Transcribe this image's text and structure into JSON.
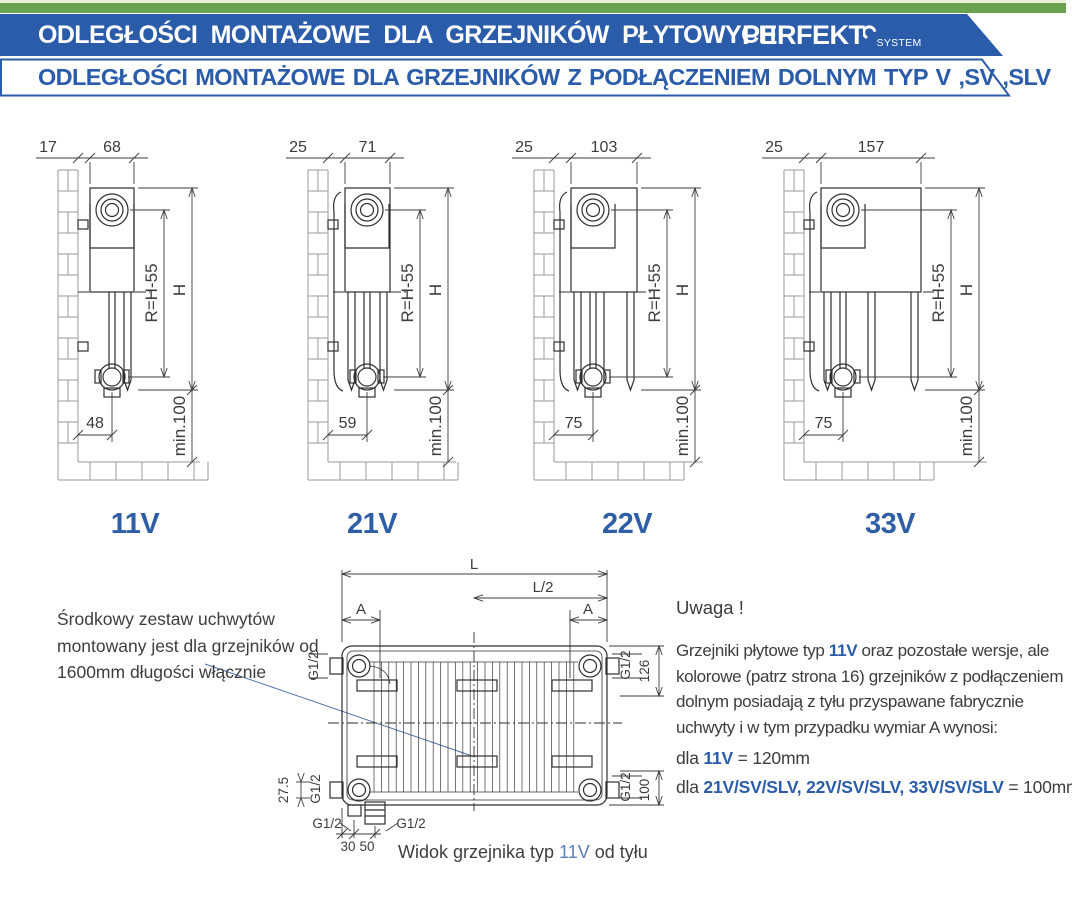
{
  "header": {
    "strip_pale_green": "#e9f3da",
    "strip_green": "#69a350",
    "accent_blue": "#2a5ca9",
    "title": "ODLEGŁOŚCI MONTAŻOWE DLA GRZEJNIKÓW PŁYTOWYCH",
    "logo": {
      "text": "PERFEKT",
      "sub": "SYSTEM"
    },
    "subtitle": "ODLEGŁOŚCI MONTAŻOWE DLA GRZEJNIKÓW Z PODŁĄCZENIEM DOLNYM TYP V ,SV ,SLV"
  },
  "diagrams": [
    {
      "type_label": "11V",
      "wall_gap": "17",
      "depth": "68",
      "r_label": "R=H-55",
      "h_label": "H",
      "bottom_dim": "48",
      "floor_label": "min.100",
      "panels": 1,
      "center_pipe": false
    },
    {
      "type_label": "21V",
      "wall_gap": "25",
      "depth": "71",
      "r_label": "R=H-55",
      "h_label": "H",
      "bottom_dim": "59",
      "floor_label": "min.100",
      "panels": 2,
      "center_pipe": false
    },
    {
      "type_label": "22V",
      "wall_gap": "25",
      "depth": "103",
      "r_label": "R=H-55",
      "h_label": "H",
      "bottom_dim": "75",
      "floor_label": "min.100",
      "panels": 2,
      "center_pipe": true
    },
    {
      "type_label": "33V",
      "wall_gap": "25",
      "depth": "157",
      "r_label": "R=H-55",
      "h_label": "H",
      "bottom_dim": "75",
      "floor_label": "min.100",
      "panels": 3,
      "center_pipe": true
    }
  ],
  "rear_view": {
    "length_label": "L",
    "half_length_label": "L/2",
    "bracket_dist_label": "A",
    "thread_label": "G1/2",
    "top_offset": "126",
    "bottom_offset": "100",
    "pipe_offset": "27.5",
    "pipe_gap_1": "30",
    "pipe_gap_2": "50",
    "caption": {
      "prefix": "Widok grzejnika typ ",
      "type": "11V",
      "suffix": " od tyłu"
    }
  },
  "notes": {
    "left_note": "Środkowy zestaw uchwytów montowany jest dla grzejników od 1600mm długości włącznie",
    "attention": {
      "heading": "Uwaga !",
      "line1_pre": "Grzejniki płytowe typ ",
      "line1_type": "11V",
      "line1_post": " oraz pozostałe wersje, ale",
      "line2": "kolorowe (patrz strona 16) grzejników z podłączeniem",
      "line3": "dolnym posiadają z tyłu przyspawane fabrycznie",
      "line4": "uchwyty i w tym przypadku wymiar A wynosi:",
      "rule1_pre": "dla ",
      "rule1_type": "11V",
      "rule1_val": " = 120mm",
      "rule2_pre": "dla ",
      "rule2_types": "21V/SV/SLV, 22V/SV/SLV, 33V/SV/SLV",
      "rule2_val": " = 100mm"
    }
  }
}
